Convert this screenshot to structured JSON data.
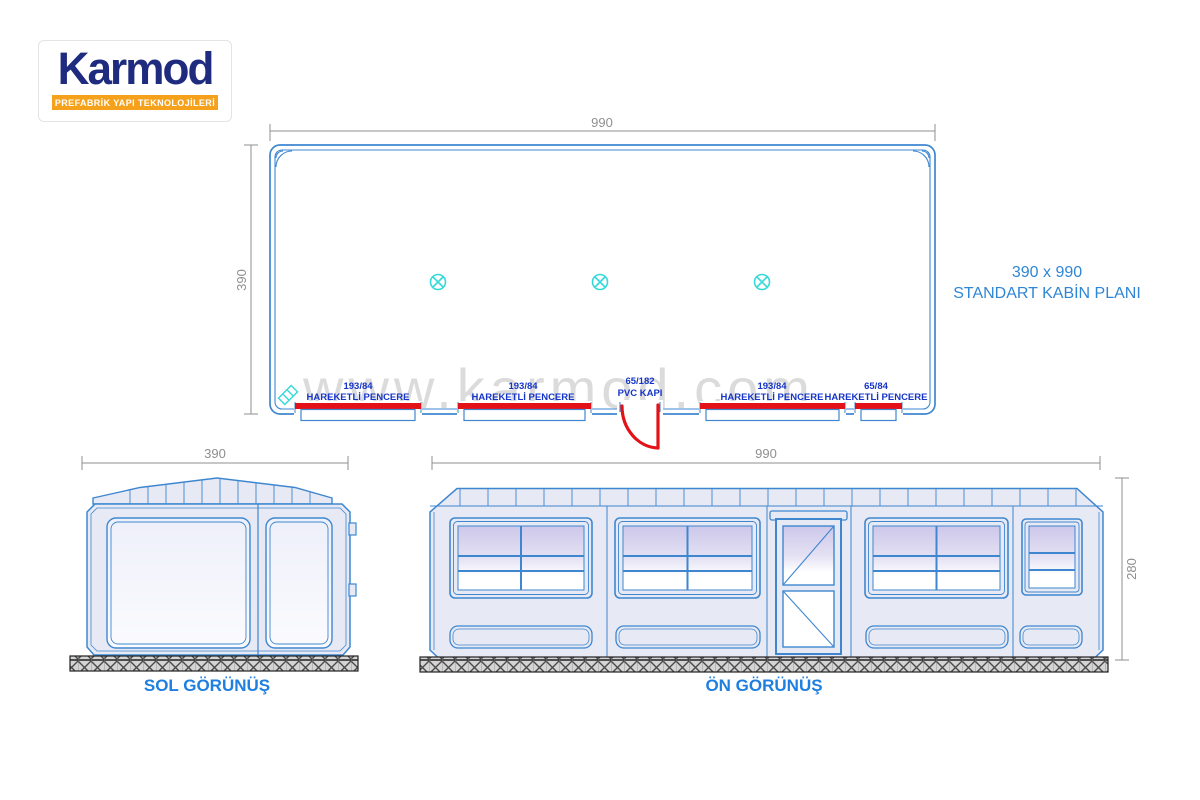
{
  "logo": {
    "brand": "Karmod",
    "tagline": "PREFABRİK YAPI TEKNOLOJİLERİ"
  },
  "watermark": "www.karmod.com",
  "colors": {
    "drawing_blue": "#3e87d0",
    "opening_label_blue": "#1535c8",
    "title_blue": "#2f86d5",
    "dimension_gray": "#8f8f8f",
    "marker_red": "#e31219",
    "fixture_cyan": "#36d9d9",
    "logo_navy": "#1e2b7e",
    "logo_orange": "#f5a11c",
    "watermark_gray": "#b9b9b9",
    "body_fill": "#e7e9f4"
  },
  "plan": {
    "width_dim": "990",
    "height_dim": "390",
    "title_line1": "390 x 990",
    "title_line2": "STANDART KABİN PLANI",
    "ceiling_light_count": 3,
    "openings": [
      {
        "size": "193/84",
        "label": "HAREKETLİ  PENCERE",
        "type": "window"
      },
      {
        "size": "193/84",
        "label": "HAREKETLİ  PENCERE",
        "type": "window"
      },
      {
        "size": "65/182",
        "label": "PVC KAPI",
        "type": "door"
      },
      {
        "size": "193/84",
        "label": "HAREKETLİ  PENCERE",
        "type": "window"
      },
      {
        "size": "65/84",
        "label": "HAREKETLİ  PENCERE",
        "type": "window"
      }
    ]
  },
  "left_view": {
    "label": "SOL GÖRÜNÜŞ",
    "width_dim": "390"
  },
  "front_view": {
    "label": "ÖN GÖRÜNÜŞ",
    "width_dim": "990",
    "height_dim": "280"
  }
}
